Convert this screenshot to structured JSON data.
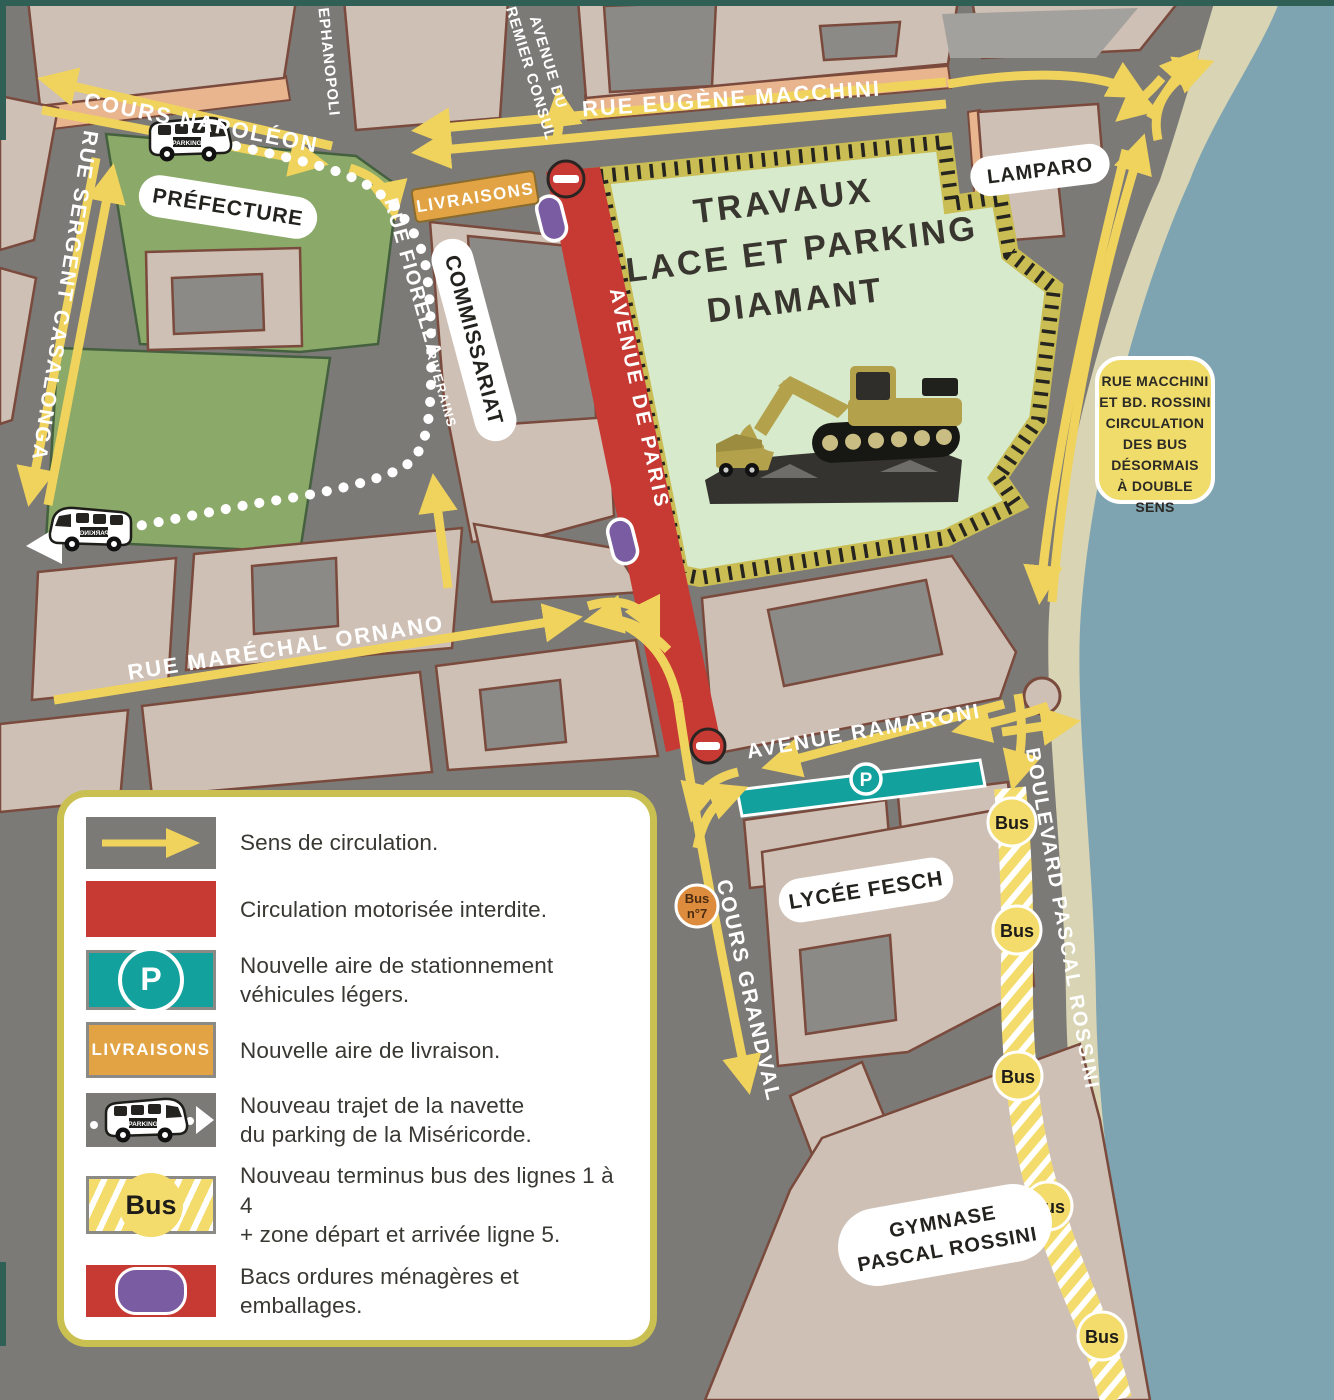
{
  "map": {
    "streets": {
      "cours_napoleon": "COURS NAPOLÉON",
      "stephanopoli": "STEPHANOPOLI",
      "premier_consul_l1": "AVENUE DU",
      "premier_consul_l2": "PREMIER CONSUL",
      "rue_eugene_macchini": "RUE EUGÈNE MACCHINI",
      "rue_sergent_casalonga": "RUE SERGENT CASALONGA",
      "rue_fiorella": "RUE FIORELLA",
      "rue_fiorella_sub": "RIVERAINS",
      "avenue_de_paris": "AVENUE DE PARIS",
      "rue_marechal_ornano": "RUE MARÉCHAL ORNANO",
      "avenue_ramaroni": "AVENUE RAMARONI",
      "cours_grandval": "COURS GRANDVAL",
      "boulevard_pascal_rossini": "BOULEVARD PASCAL ROSSINI"
    },
    "places": {
      "prefecture": "PRÉFECTURE",
      "commissariat": "COMMISSARIAT",
      "lamparo": "LAMPARO",
      "lycee_fesch": "LYCÉE FESCH",
      "gymnase_l1": "GYMNASE",
      "gymnase_l2": "PASCAL ROSSINI"
    },
    "construction_zone": {
      "l1": "TRAVAUX",
      "l2": "PLACE ET PARKING",
      "l3": "DIAMANT"
    },
    "notice": {
      "lines": [
        "RUE MACCHINI",
        "ET BD. ROSSINI",
        "CIRCULATION",
        "DES BUS",
        "DÉSORMAIS",
        "À DOUBLE SENS"
      ]
    },
    "badges": {
      "parking": "P",
      "livraisons": "LIVRAISONS",
      "bus": "Bus",
      "bus7_l1": "Bus",
      "bus7_l2": "n°7",
      "van": "PARKING"
    }
  },
  "legend": {
    "items": [
      {
        "id": "direction",
        "label": "Sens de circulation."
      },
      {
        "id": "no-motor",
        "label": "Circulation motorisée interdite."
      },
      {
        "id": "parking",
        "label": "Nouvelle aire de stationnement\nvéhicules légers."
      },
      {
        "id": "delivery",
        "label": "Nouvelle aire de livraison."
      },
      {
        "id": "shuttle",
        "label": "Nouveau trajet de la navette\ndu parking de la Miséricorde."
      },
      {
        "id": "bus-terminus",
        "label": "Nouveau terminus bus des lignes 1 à 4\n+ zone départ et arrivée ligne 5."
      },
      {
        "id": "bins",
        "label": "Bacs ordures ménagères et emballages."
      }
    ],
    "parking_badge": "P",
    "livraisons_badge": "LIVRAISONS",
    "bus_badge": "Bus"
  },
  "colors": {
    "road": "#7b7a77",
    "building": "#cfc0b5",
    "sea": "#7fa4b1",
    "beach": "#d8d4b4",
    "park_green": "#8ba968",
    "construction_green": "#d7eacb",
    "closed_road_red": "#c63a33",
    "arrow_yellow": "#f0d35c",
    "parking_teal": "#12a19d",
    "delivery_orange": "#e2a344",
    "bins_purple": "#7a5ca2",
    "bus_zone_yellow": "#f3dc6b"
  }
}
